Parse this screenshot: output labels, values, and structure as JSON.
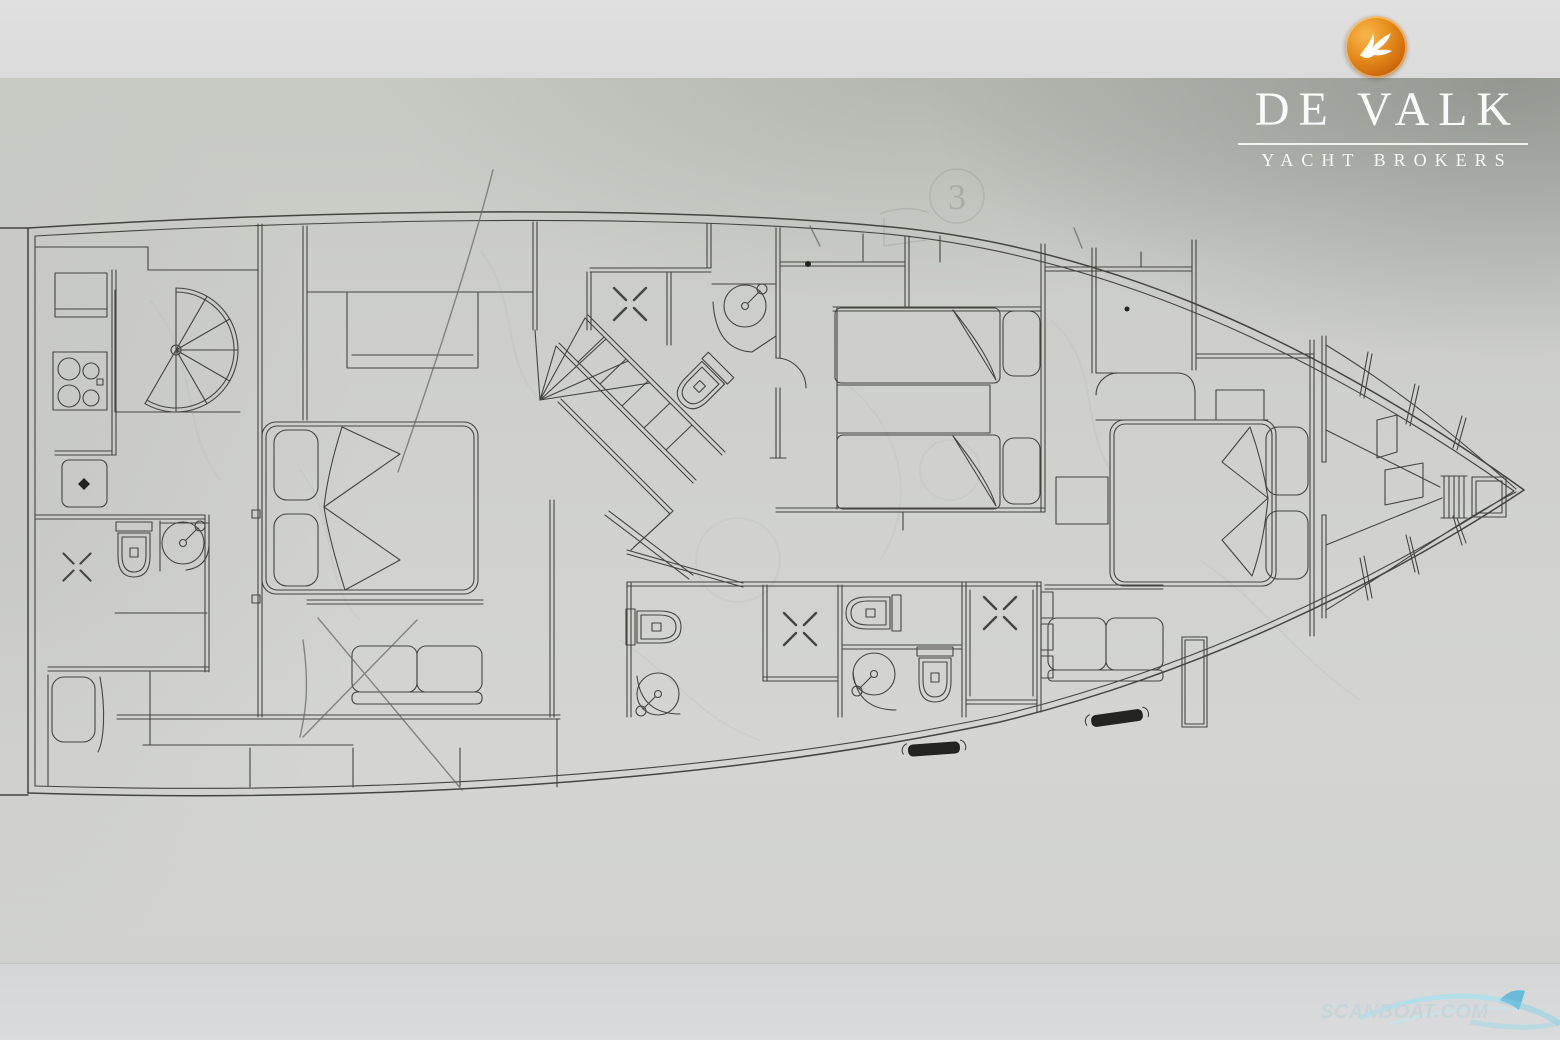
{
  "brand": {
    "name": "DE VALK",
    "tagline": "YACHT BROKERS",
    "logo_icon": "falcon-icon",
    "logo_ball_color": "#dd7f14",
    "text_color": "#ffffff"
  },
  "watermark": {
    "text": "SCANBOAT.COM",
    "icon": "wave-swoosh-icon",
    "color": "#c6d4da"
  },
  "annotation": {
    "faint_frame_number": "3"
  },
  "palette": {
    "paper": "#cfd0cb",
    "top_strip": "#dddedd",
    "bottom_strip": "#d7d8d9",
    "ink": "#45453f",
    "pencil": "#63635c",
    "corner_shadow": "#48514f"
  },
  "plan": {
    "drawing": "yacht lower deck floor plan, top view, bow to the right",
    "rooms": [
      {
        "name": "galley",
        "features": [
          "four-burner-stove",
          "sink",
          "counter",
          "spiral-staircase",
          "overhead-lockers"
        ]
      },
      {
        "name": "aft-port-bathroom",
        "features": [
          "toilet",
          "round-shower",
          "shower-floor-cross"
        ]
      },
      {
        "name": "aft-berth",
        "features": [
          "single-berth",
          "pillow"
        ]
      },
      {
        "name": "aft-cabin",
        "features": [
          "double-bed",
          "two-pillows",
          "sofa",
          "wardrobe",
          "cabinet"
        ]
      },
      {
        "name": "midship-stairwell",
        "features": [
          "stair-flight",
          "fan-steps",
          "handrail"
        ]
      },
      {
        "name": "midship-bathroom",
        "features": [
          "toilet",
          "round-shower",
          "shower-floor-cross"
        ]
      },
      {
        "name": "guest-bathrooms",
        "features": [
          "toilet",
          "toilet",
          "toilet",
          "round-shower",
          "round-shower",
          "shower-floor-cross",
          "shower-floor-cross",
          "bench"
        ]
      },
      {
        "name": "twin-guest-cabin",
        "features": [
          "single-bed",
          "single-bed",
          "two-pillows",
          "nightstand-shelf",
          "overhead-lockers"
        ]
      },
      {
        "name": "owner-cabin",
        "features": [
          "double-bed",
          "two-pillows",
          "sofa",
          "nightstand",
          "vanity-counter",
          "wardrobe",
          "bench"
        ]
      },
      {
        "name": "bow-compartment",
        "features": [
          "structural-frames",
          "ladder",
          "anchor-locker"
        ]
      }
    ]
  }
}
